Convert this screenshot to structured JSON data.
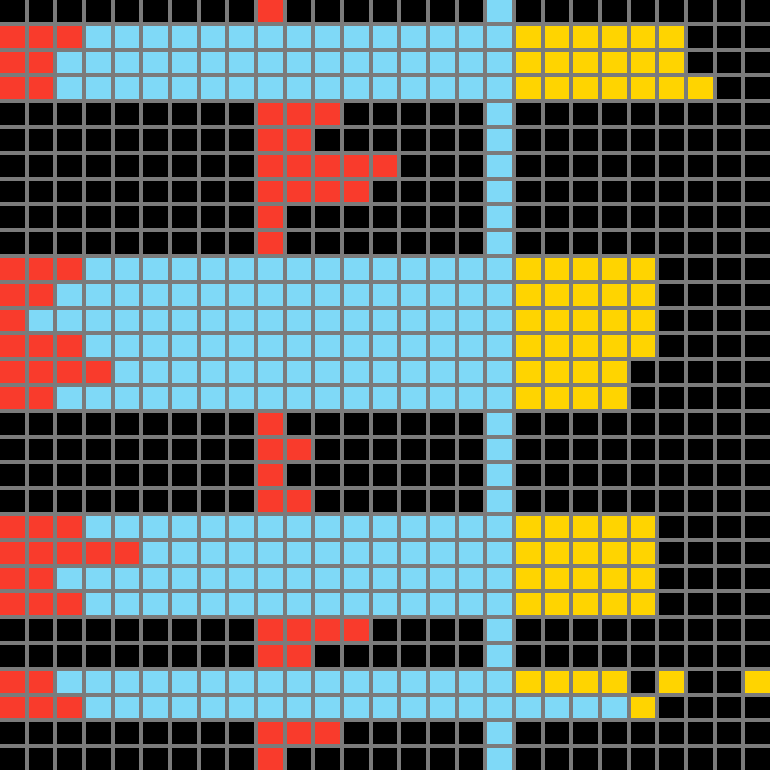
{
  "title": "pixel-grid-canvas",
  "grid": {
    "columns": 27,
    "rows_count": 30,
    "line_color": "#7b7b7b",
    "palette": {
      "K": "#000000",
      "R": "#f93b2c",
      "B": "#7fd9f7",
      "Y": "#ffd400"
    },
    "palette_names": {
      "K": "black",
      "R": "red",
      "B": "sky-blue",
      "Y": "yellow"
    },
    "rows": [
      "KKKKKKKKKRKKKKKKKBKKKKKKKKK",
      "RRRBBBBBBBBBBBBBBBYYYYYYKKK",
      "RRBBBBBBBBBBBBBBBBYYYYYYKKK",
      "RRBBBBBBBBBBBBBBBBYYYYYYYKK",
      "KKKKKKKKKRRRKKKKKBKKKKKKKKK",
      "KKKKKKKKKRRKKKKKKBKKKKKKKKK",
      "KKKKKKKKKRRRRRKKKBKKKKKKKKK",
      "KKKKKKKKKRRRRKKKKBKKKKKKKKK",
      "KKKKKKKKKRKKKKKKKBKKKKKKKKK",
      "KKKKKKKKKRKKKKKKKBKKKKKKKKK",
      "RRRBBBBBBBBBBBBBBBYYYYYKKKK",
      "RRBBBBBBBBBBBBBBBBYYYYYKKKK",
      "RBBBBBBBBBBBBBBBBBYYYYYKKKK",
      "RRRBBBBBBBBBBBBBBBYYYYYKKKK",
      "RRRRBBBBBBBBBBBBBBYYYYKKKKK",
      "RRBBBBBBBBBBBBBBBBYYYYKKKKK",
      "KKKKKKKKKRKKKKKKKBKKKKKKKKK",
      "KKKKKKKKKRRKKKKKKBKKKKKKKKK",
      "KKKKKKKKKRKKKKKKKBKKKKKKKKK",
      "KKKKKKKKKRRKKKKKKBKKKKKKKKK",
      "RRRBBBBBBBBBBBBBBBYYYYYKKKK",
      "RRRRRBBBBBBBBBBBBBYYYYYKKKK",
      "RRBBBBBBBBBBBBBBBBYYYYYKKKK",
      "RRRBBBBBBBBBBBBBBBYYYYYKKKK",
      "KKKKKKKKKRRRRKKKKBKKKKKKKKK",
      "KKKKKKKKKRRKKKKKKBKKKKKKKKK",
      "RRBBBBBBBBBBBBBBBBYYYYKYKKY",
      "RRRBBBBBBBBBBBBBBBBBBBYKKK",
      "KKKKKKKKKRRRKKKKKBKKKKKKKKK",
      "KKKKKKKKKRKKKKKKKBKKKKKKKKK"
    ]
  }
}
